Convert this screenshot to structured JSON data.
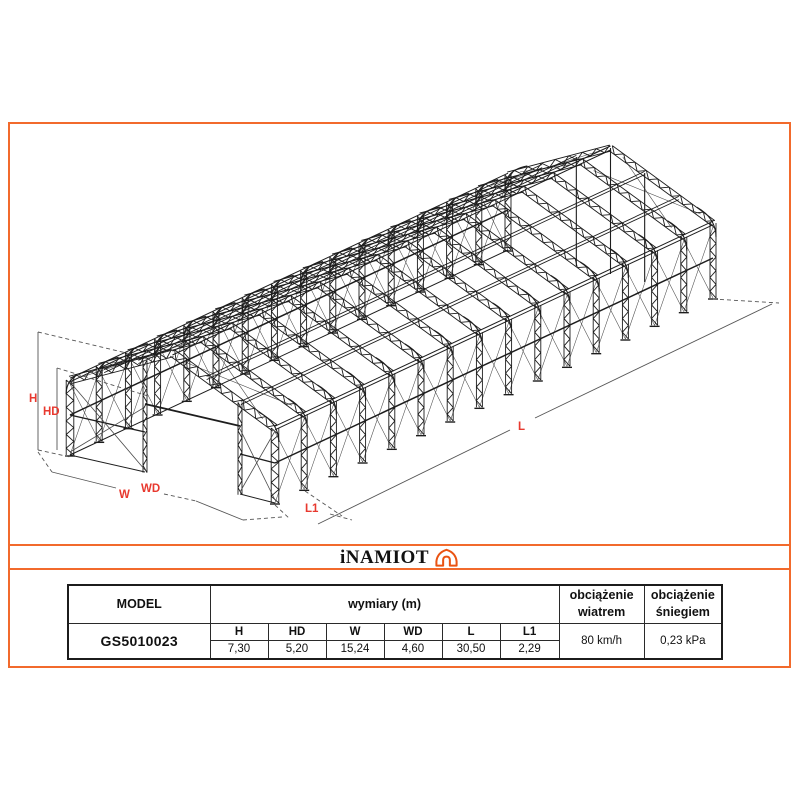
{
  "colors": {
    "accent": "#F26A2C",
    "dim_label": "#E8392F",
    "structure_line": "#1d1d1d",
    "thin_line": "#4a4a4a",
    "dim_line": "#555555"
  },
  "logo": {
    "text": "iNAMIOT",
    "icon": "tent-icon"
  },
  "drawing": {
    "labels": {
      "h": "H",
      "hd": "HD",
      "w": "W",
      "wd": "WD",
      "l": "L",
      "l1": "L1"
    }
  },
  "table": {
    "model_header": "MODEL",
    "model_value": "GS5010023",
    "dims_header": "wymiary (m)",
    "dims": [
      {
        "label": "H",
        "value": "7,30"
      },
      {
        "label": "HD",
        "value": "5,20"
      },
      {
        "label": "W",
        "value": "15,24"
      },
      {
        "label": "WD",
        "value": "4,60"
      },
      {
        "label": "L",
        "value": "30,50"
      },
      {
        "label": "L1",
        "value": "2,29"
      }
    ],
    "wind_header": "obciążenie wiatrem",
    "wind_value": "80 km/h",
    "snow_header": "obciążenie śniegiem",
    "snow_value": "0,23 kPa"
  }
}
